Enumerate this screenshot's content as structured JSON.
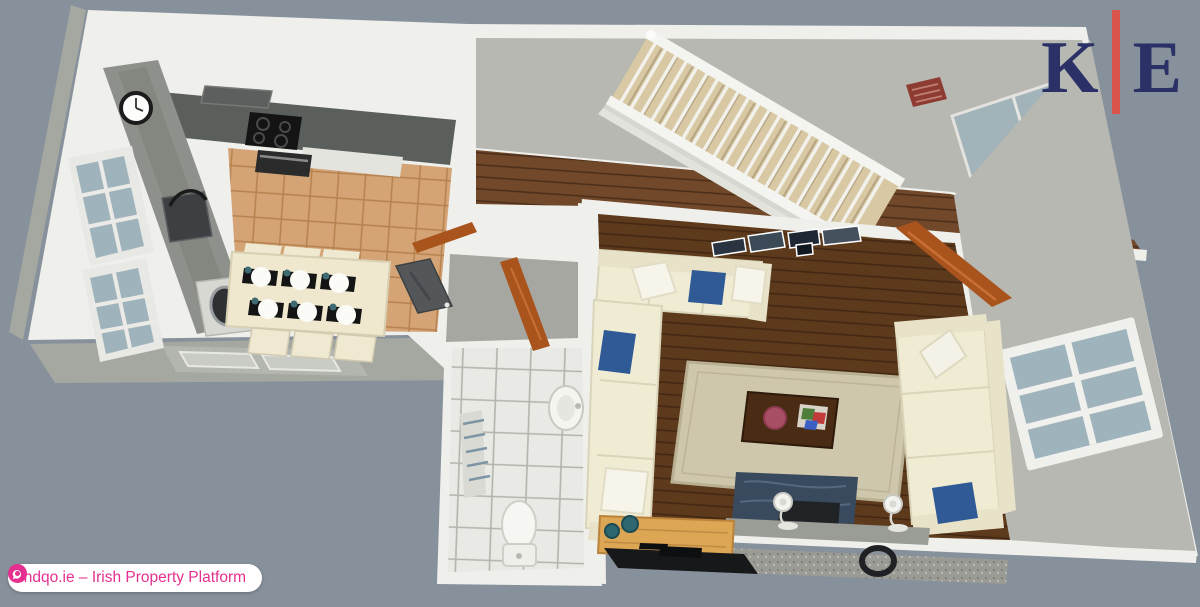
{
  "branding": {
    "logo": {
      "left": "K",
      "right": "E",
      "divider": "red-vertical-bar"
    },
    "badge": {
      "text": "findqo.ie – Irish Property Platform",
      "icon": "findqo-globe-icon"
    }
  },
  "scene": {
    "type": "3d-floor-plan-render",
    "view": "isometric-top-down",
    "rooms": [
      {
        "name": "kitchen-dining",
        "features": [
          "wall-clock",
          "range-hood",
          "cooktop",
          "oven",
          "sink",
          "washing-machine",
          "l-shaped-counter",
          "dining-table",
          "six-place-settings",
          "chairs",
          "tan-tile-floor",
          "paned-windows"
        ]
      },
      {
        "name": "hallway",
        "features": [
          "white-staircase",
          "wood-plank-floor",
          "red-wall-sign",
          "glazed-door"
        ]
      },
      {
        "name": "entry",
        "features": [
          "front-door",
          "open-wood-door"
        ]
      },
      {
        "name": "bathroom",
        "features": [
          "toilet",
          "pedestal-sink",
          "white-tile-floor",
          "radiator",
          "open-wood-door"
        ]
      },
      {
        "name": "living-room",
        "features": [
          "l-shaped-sofa",
          "three-seat-sofa",
          "blue-cushions",
          "white-cushions",
          "area-rug",
          "coffee-table",
          "gallery-frames",
          "fireplace",
          "stove",
          "table-lamps",
          "pine-sideboard",
          "tv-unit",
          "paned-window",
          "open-wood-door",
          "wreath-ring"
        ]
      }
    ]
  },
  "palette": {
    "background": "#87919b",
    "wall_white": "#efefec",
    "wall_face_gray": "#b7b8b2",
    "wall_face_dark": "#a5a7a1",
    "wood_hall": "#71482a",
    "wood_living": "#5e3a1d",
    "tile_tan": "#d4a476",
    "bath_tile": "#e9e9e5",
    "counter_dark": "#5a5f5c",
    "counter_gray": "#8e918b",
    "sofa_cream": "#f0ecd4",
    "sofa_shadow": "#e7e2c8",
    "pillow_blue": "#2f5a96",
    "rug_beige": "#cfc7ab",
    "table_wood": "#4a2c15",
    "door_orange": "#a9531d",
    "fireplace_navy": "#394a5e",
    "sideboard_pine": "#dca654",
    "glass_blue": "#9fb3bc",
    "stairs_tread": "#d8c9a4",
    "sign_red": "#8e3b32",
    "logo_navy": "#2b3166",
    "logo_red": "#d9544a",
    "badge_pink": "#e5308f",
    "badge_bg": "#ffffff"
  }
}
